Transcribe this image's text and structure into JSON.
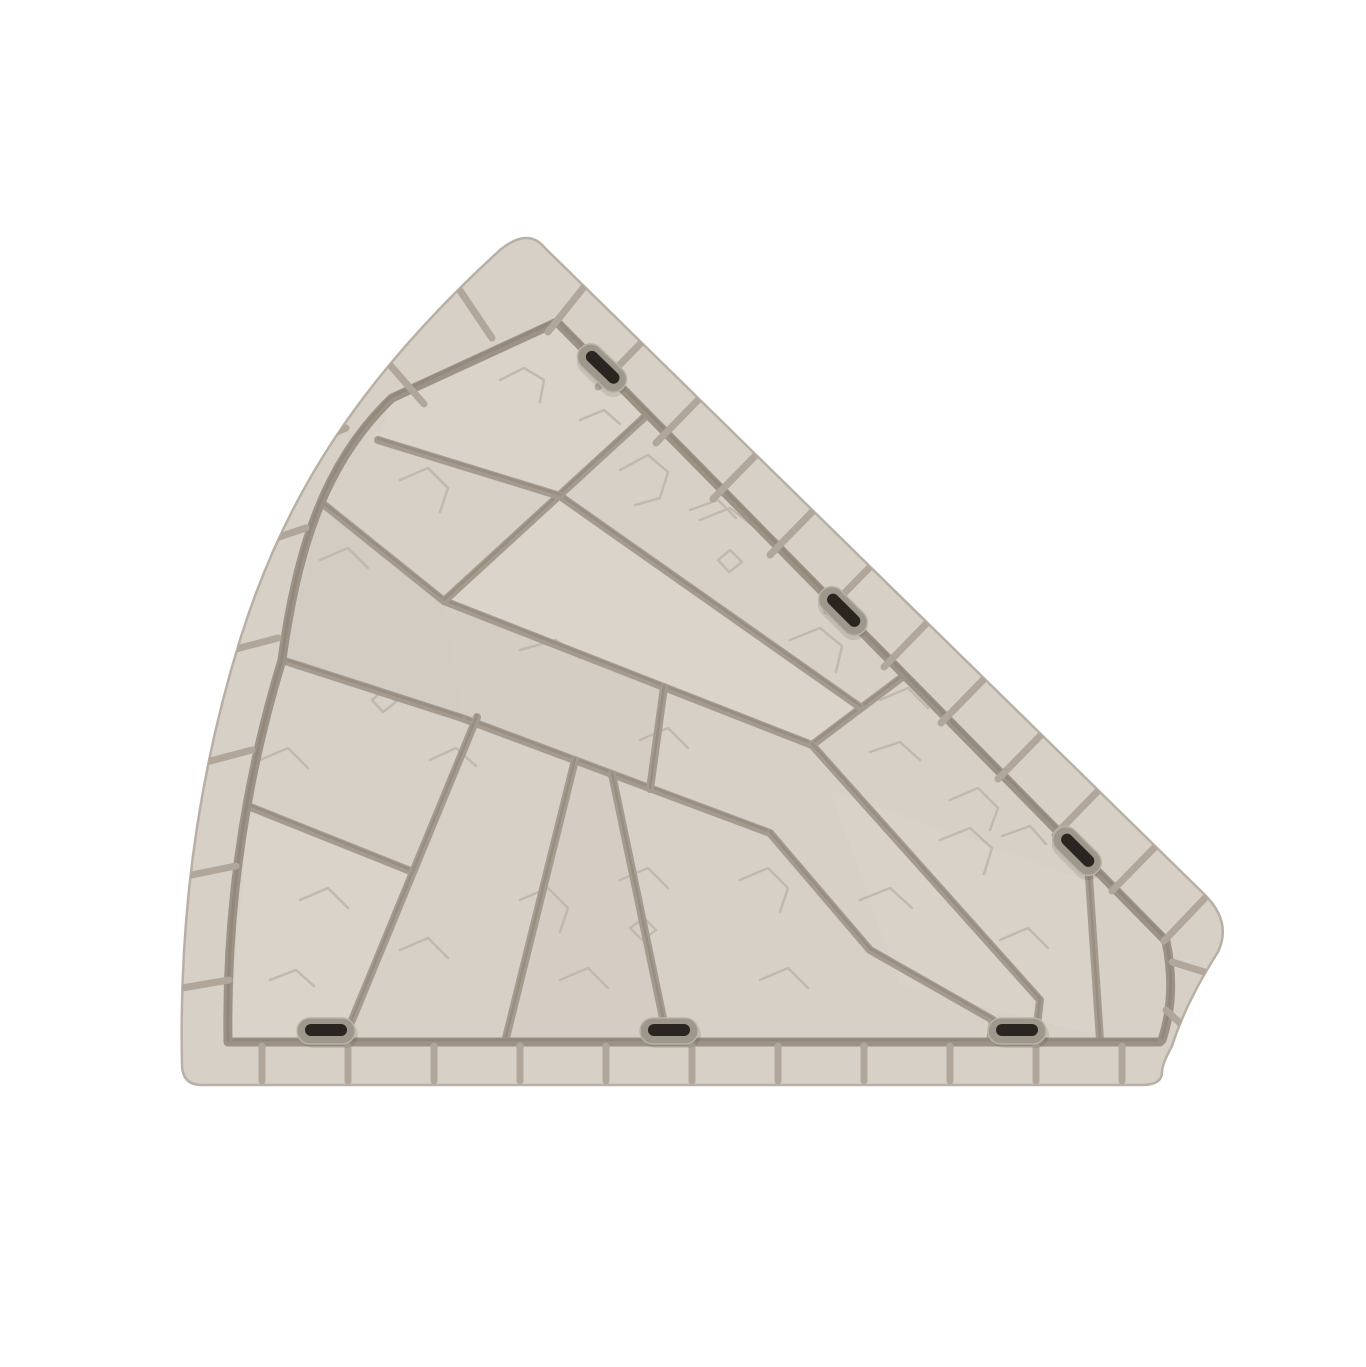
{
  "canvas": {
    "width": 1366,
    "height": 1367
  },
  "illustration": {
    "label": "Beige fan-shaped stone paver tile with brick border and connector slots",
    "colors": {
      "background": "#ffffff",
      "stone": "#d7d0c7",
      "stone_light": "#ded8cf",
      "stone_dark": "#cfc7bd",
      "rim": "#b9b0a5",
      "groove": "#9c9386",
      "groove_dark": "#877d70",
      "border_joint": "#b0a79a",
      "interior_joint": "#a49b8e",
      "crack": "#c2b9ae",
      "slot_ring": "#9e978c",
      "slot_ring_light": "#b9b2a7",
      "slot_hole": "#2a2520",
      "slot_shadow": "rgba(60,50,40,0.12)"
    },
    "silhouette": "M 545 248 L 1205 895 Q 1232 922 1218 952 Q 1186 1002 1172 1046 Q 1162 1064 1162 1072 Q 1162 1085 1142 1085 L 202 1085 Q 182 1085 182 1064 C 179 925 196 782 240 640 C 284 498 358 380 500 250 Q 528 227 545 248 Z",
    "frame_grooves": [
      "M 230 1042 L 1160 1042",
      "M 228 1042 C 226 915 243 788 282 660 C 296 556 322 464 392 398 L 557 322",
      "M 557 322 L 1166 941",
      "M 1166 941 Q 1177 995 1162 1040"
    ],
    "border_joints": {
      "bottom": [
        [
          262,
          1046,
          262,
          1081
        ],
        [
          348,
          1046,
          348,
          1081
        ],
        [
          434,
          1046,
          434,
          1081
        ],
        [
          520,
          1046,
          520,
          1081
        ],
        [
          606,
          1046,
          606,
          1081
        ],
        [
          692,
          1046,
          692,
          1081
        ],
        [
          778,
          1046,
          778,
          1081
        ],
        [
          864,
          1046,
          864,
          1081
        ],
        [
          950,
          1046,
          950,
          1081
        ],
        [
          1036,
          1046,
          1036,
          1081
        ],
        [
          1122,
          1046,
          1122,
          1081
        ]
      ],
      "left_arc": [
        [
          182,
          988,
          229,
          980
        ],
        [
          186,
          876,
          236,
          866
        ],
        [
          199,
          764,
          252,
          750
        ],
        [
          221,
          653,
          278,
          638
        ],
        [
          252,
          546,
          306,
          528
        ],
        [
          294,
          450,
          346,
          428
        ],
        [
          390,
          365,
          424,
          404
        ],
        [
          459,
          289,
          492,
          338
        ]
      ],
      "top_right": [
        [
          584,
          287,
          548,
          332
        ],
        [
          641,
          343,
          598,
          387
        ],
        [
          699,
          399,
          656,
          443
        ],
        [
          756,
          455,
          713,
          499
        ],
        [
          813,
          511,
          770,
          555
        ],
        [
          870,
          567,
          827,
          611
        ],
        [
          927,
          623,
          884,
          667
        ],
        [
          984,
          679,
          941,
          723
        ],
        [
          1041,
          735,
          998,
          779
        ],
        [
          1098,
          791,
          1055,
          835
        ],
        [
          1155,
          847,
          1112,
          891
        ],
        [
          1205,
          898,
          1164,
          941
        ]
      ],
      "inner_arc": [
        [
          1214,
          975,
          1172,
          962
        ],
        [
          1183,
          1026,
          1166,
          1010
        ]
      ]
    },
    "interior_joints": [
      [
        [
          444,
          601
        ],
        [
          812,
          745
        ]
      ],
      [
        [
          462,
          718
        ],
        [
          770,
          833
        ]
      ],
      [
        [
          282,
          660
        ],
        [
          462,
          718
        ]
      ],
      [
        [
          248,
          806
        ],
        [
          413,
          872
        ]
      ],
      [
        [
          444,
          601
        ],
        [
          322,
          503
        ]
      ],
      [
        [
          477,
          717
        ],
        [
          343,
          1042
        ]
      ],
      [
        [
          575,
          760
        ],
        [
          505,
          1042
        ]
      ],
      [
        [
          612,
          774
        ],
        [
          668,
          1042
        ]
      ],
      [
        [
          664,
          687
        ],
        [
          650,
          789
        ]
      ],
      [
        [
          770,
          833
        ],
        [
          870,
          950
        ],
        [
          993,
          1020
        ],
        [
          990,
          1042
        ]
      ],
      [
        [
          648,
          414
        ],
        [
          444,
          601
        ]
      ],
      [
        [
          905,
          675
        ],
        [
          812,
          745
        ]
      ],
      [
        [
          560,
          496
        ],
        [
          860,
          707
        ]
      ],
      [
        [
          378,
          440
        ],
        [
          560,
          496
        ]
      ],
      [
        [
          812,
          745
        ],
        [
          1040,
          1000
        ],
        [
          1035,
          1042
        ]
      ],
      [
        [
          1088,
          862
        ],
        [
          1100,
          1040
        ]
      ]
    ],
    "tints": [
      {
        "points": [
          [
            282,
            660
          ],
          [
            322,
            503
          ],
          [
            444,
            601
          ],
          [
            462,
            718
          ]
        ],
        "fill": "#cfc7bd",
        "opacity": 0.45
      },
      {
        "points": [
          [
            560,
            496
          ],
          [
            860,
            707
          ],
          [
            812,
            745
          ],
          [
            444,
            601
          ]
        ],
        "fill": "#ded8cf",
        "opacity": 0.5
      },
      {
        "points": [
          [
            444,
            601
          ],
          [
            664,
            687
          ],
          [
            650,
            789
          ],
          [
            462,
            718
          ]
        ],
        "fill": "#cfc7bd",
        "opacity": 0.4
      },
      {
        "points": [
          [
            230,
            1042
          ],
          [
            248,
            806
          ],
          [
            413,
            872
          ],
          [
            343,
            1042
          ]
        ],
        "fill": "#ded8cf",
        "opacity": 0.45
      },
      {
        "points": [
          [
            505,
            1042
          ],
          [
            575,
            760
          ],
          [
            612,
            774
          ],
          [
            668,
            1042
          ]
        ],
        "fill": "#cfc7bd",
        "opacity": 0.3
      },
      {
        "points": [
          [
            830,
            790
          ],
          [
            1085,
            880
          ],
          [
            1095,
            1035
          ],
          [
            900,
            985
          ]
        ],
        "fill": "#ded8cf",
        "opacity": 0.35
      },
      {
        "points": [
          [
            392,
            398
          ],
          [
            557,
            322
          ],
          [
            648,
            414
          ],
          [
            560,
            496
          ],
          [
            378,
            440
          ]
        ],
        "fill": "#ded8cf",
        "opacity": 0.4
      }
    ],
    "cracks": [
      [
        500,
        380,
        524,
        368,
        544,
        380,
        540,
        402
      ],
      [
        580,
        420,
        604,
        410,
        620,
        424
      ],
      [
        620,
        470,
        648,
        455,
        668,
        472,
        660,
        498,
        635,
        505
      ],
      [
        700,
        520,
        730,
        508,
        752,
        525
      ],
      [
        790,
        640,
        820,
        628,
        842,
        646,
        836,
        672
      ],
      [
        880,
        700,
        908,
        688,
        928,
        708
      ],
      [
        950,
        800,
        978,
        788,
        998,
        808,
        990,
        830
      ],
      [
        1002,
        836,
        1030,
        826,
        1046,
        844
      ],
      [
        940,
        840,
        970,
        828,
        992,
        848,
        984,
        874
      ],
      [
        860,
        900,
        890,
        888,
        912,
        908
      ],
      [
        740,
        880,
        768,
        868,
        788,
        888,
        780,
        912
      ],
      [
        620,
        880,
        648,
        868,
        668,
        888
      ],
      [
        520,
        900,
        548,
        888,
        568,
        908,
        560,
        932
      ],
      [
        400,
        950,
        428,
        938,
        448,
        958
      ],
      [
        300,
        900,
        328,
        888,
        348,
        908
      ],
      [
        260,
        760,
        288,
        748,
        308,
        768
      ],
      [
        320,
        560,
        348,
        548,
        368,
        568
      ],
      [
        400,
        480,
        428,
        468,
        448,
        488,
        440,
        512
      ],
      [
        520,
        650,
        556,
        640,
        580,
        658
      ],
      [
        640,
        740,
        668,
        728,
        688,
        748
      ],
      [
        870,
        752,
        900,
        742,
        920,
        760
      ],
      [
        1000,
        940,
        1028,
        928,
        1048,
        948
      ],
      [
        560,
        980,
        588,
        968,
        608,
        988
      ],
      [
        760,
        980,
        788,
        968,
        808,
        988
      ],
      [
        630,
        928,
        644,
        918,
        656,
        930,
        642,
        940,
        630,
        928
      ],
      [
        372,
        700,
        384,
        690,
        396,
        702,
        383,
        712,
        372,
        700
      ],
      [
        718,
        560,
        730,
        550,
        742,
        562,
        729,
        572,
        718,
        560
      ],
      [
        690,
        510,
        718,
        500,
        736,
        518
      ],
      [
        270,
        980,
        296,
        970,
        314,
        986
      ],
      [
        430,
        760,
        456,
        748,
        476,
        766
      ]
    ],
    "slots": {
      "ring": {
        "width": 58,
        "height": 26,
        "radius": 13
      },
      "hole": {
        "width": 42,
        "height": 12,
        "radius": 6
      },
      "items": [
        {
          "cx": 602,
          "cy": 368,
          "rotation": 44
        },
        {
          "cx": 843,
          "cy": 611,
          "rotation": 45
        },
        {
          "cx": 1077,
          "cy": 851,
          "rotation": 45
        },
        {
          "cx": 326,
          "cy": 1031,
          "rotation": 0
        },
        {
          "cx": 669,
          "cy": 1031,
          "rotation": 0
        },
        {
          "cx": 1017,
          "cy": 1031,
          "rotation": 0
        }
      ]
    },
    "stroke_widths": {
      "frame_groove": 9,
      "frame_groove_core": 3,
      "border_joint": 7,
      "interior_joint": 8,
      "interior_joint_core": 2.5,
      "crack": 2.5,
      "rim": 2.5
    }
  }
}
